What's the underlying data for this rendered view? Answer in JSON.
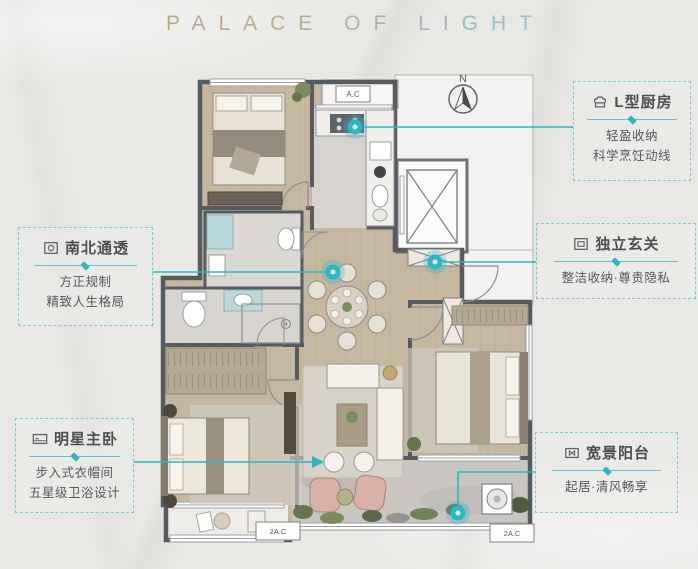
{
  "title": "PALACE OF LIGHT",
  "plan": {
    "compass": "N",
    "ac_top": "A.C",
    "ac_bottom_left": "2A.C",
    "ac_bottom_right": "2A.C"
  },
  "callouts": [
    {
      "id": "kitchen",
      "icon": "chef-hat-icon",
      "title": "L型厨房",
      "lines": [
        "轻盈收纳",
        "科学烹饪动线"
      ]
    },
    {
      "id": "foyer",
      "icon": "cabinet-icon",
      "title": "独立玄关",
      "lines": [
        "整洁收纳·尊贵隐私"
      ]
    },
    {
      "id": "north-south",
      "icon": "layout-icon",
      "title": "南北通透",
      "lines": [
        "方正规制",
        "精致人生格局"
      ]
    },
    {
      "id": "master-bedroom",
      "icon": "bed-icon",
      "title": "明星主卧",
      "lines": [
        "步入式衣帽间",
        "五星级卫浴设计"
      ]
    },
    {
      "id": "balcony",
      "icon": "window-icon",
      "title": "宽景阳台",
      "lines": [
        "起居·清风畅享"
      ]
    }
  ],
  "colors": {
    "accent": "#2fb6c2",
    "wall": "#565b60",
    "wood_floor": "#c6b8a0",
    "tile_floor": "#dbd8d4",
    "title_gold": "#c2a477",
    "title_teal": "#93c0c2"
  }
}
